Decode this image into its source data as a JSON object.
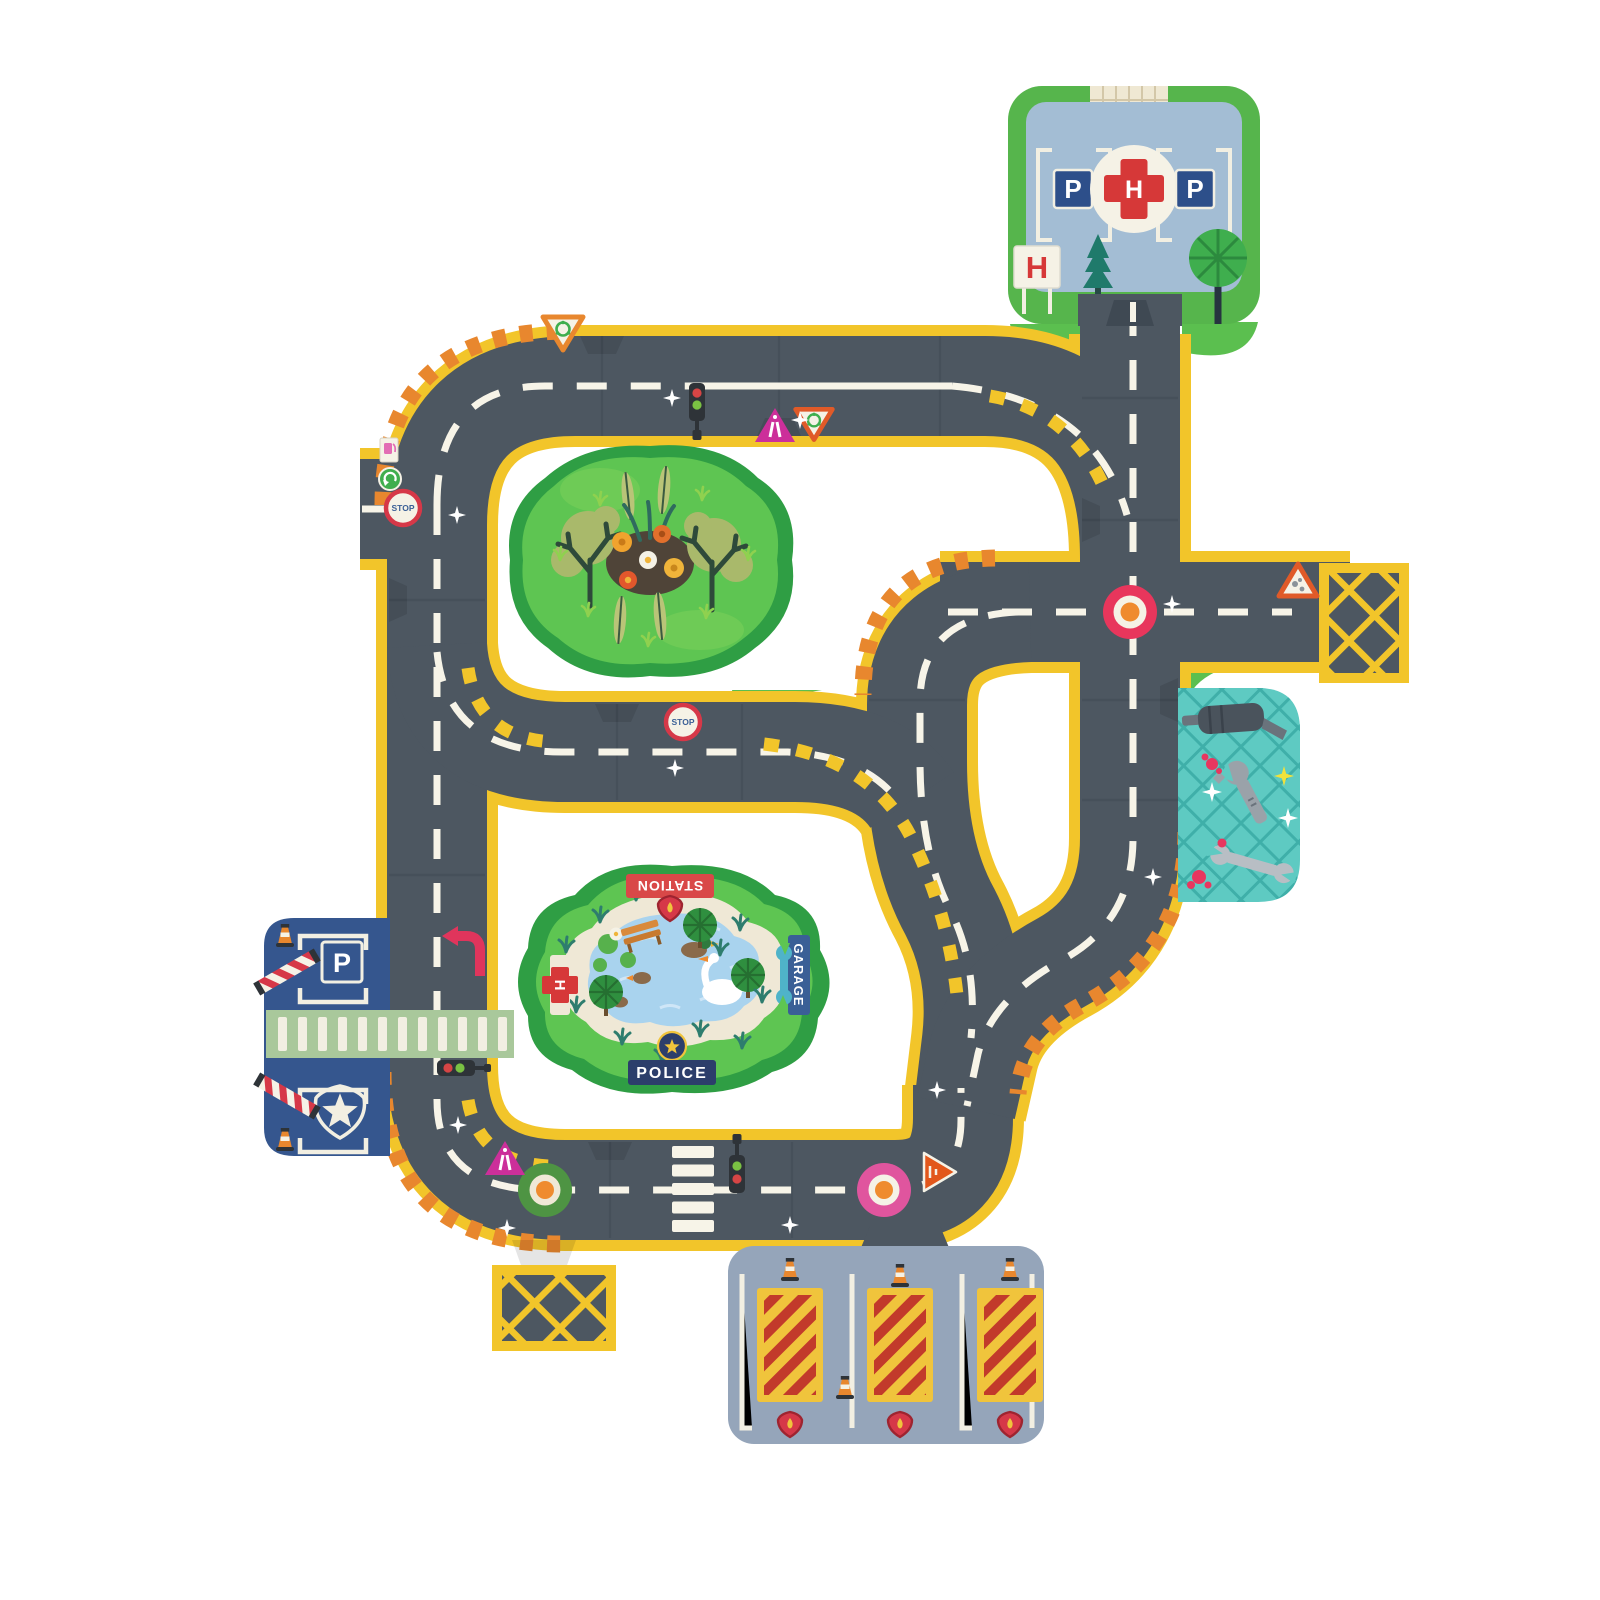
{
  "product": {
    "type": "kids-road-puzzle-playmat",
    "tile_shape": "jigsaw-puzzle-pieces"
  },
  "colors": {
    "background": "#ffffff",
    "road_asphalt": "#4d5761",
    "road_edge_yellow": "#f2c52a",
    "marking_white": "#f7f4e8",
    "hazard_stripe_orange": "#e8872e",
    "grass_green": "#5bbf4f",
    "forest_dark_green": "#2f9e44",
    "pond_water_blue": "#a9d3ee",
    "pond_stone_cream": "#efe8d6",
    "hospital_frame_green": "#56b54c",
    "hospital_pad_blue": "#a3bdd4",
    "police_tile_blue": "#35568e",
    "garage_tile_teal": "#5ecac2",
    "fire_station_gray": "#95a5ba",
    "fire_bay_yellow": "#f0c43c",
    "fire_bay_stripe_red": "#c23a2b",
    "roundabout_red": "#e8365c",
    "roundabout_green": "#4e9443",
    "roundabout_pink": "#e0559e",
    "roundabout_center_orange": "#ef8b2e",
    "warning_sign_magenta": "#cc2f9a",
    "crossing_band_green": "#a9c89b"
  },
  "tiles": {
    "hospital": {
      "parking_left_label": "P",
      "helipad_label": "H",
      "parking_right_label": "P",
      "entrance_sign_label": "H"
    },
    "police_station": {
      "parking_sign_label": "P"
    },
    "park_pond": {
      "direction_signs": {
        "station": "STATION",
        "garage": "GARAGE",
        "police": "POLICE",
        "hospital": "H"
      }
    },
    "fire_station": {
      "bay_count": "3"
    }
  },
  "signs": {
    "stop_left": "STOP",
    "stop_middle": "STOP"
  }
}
